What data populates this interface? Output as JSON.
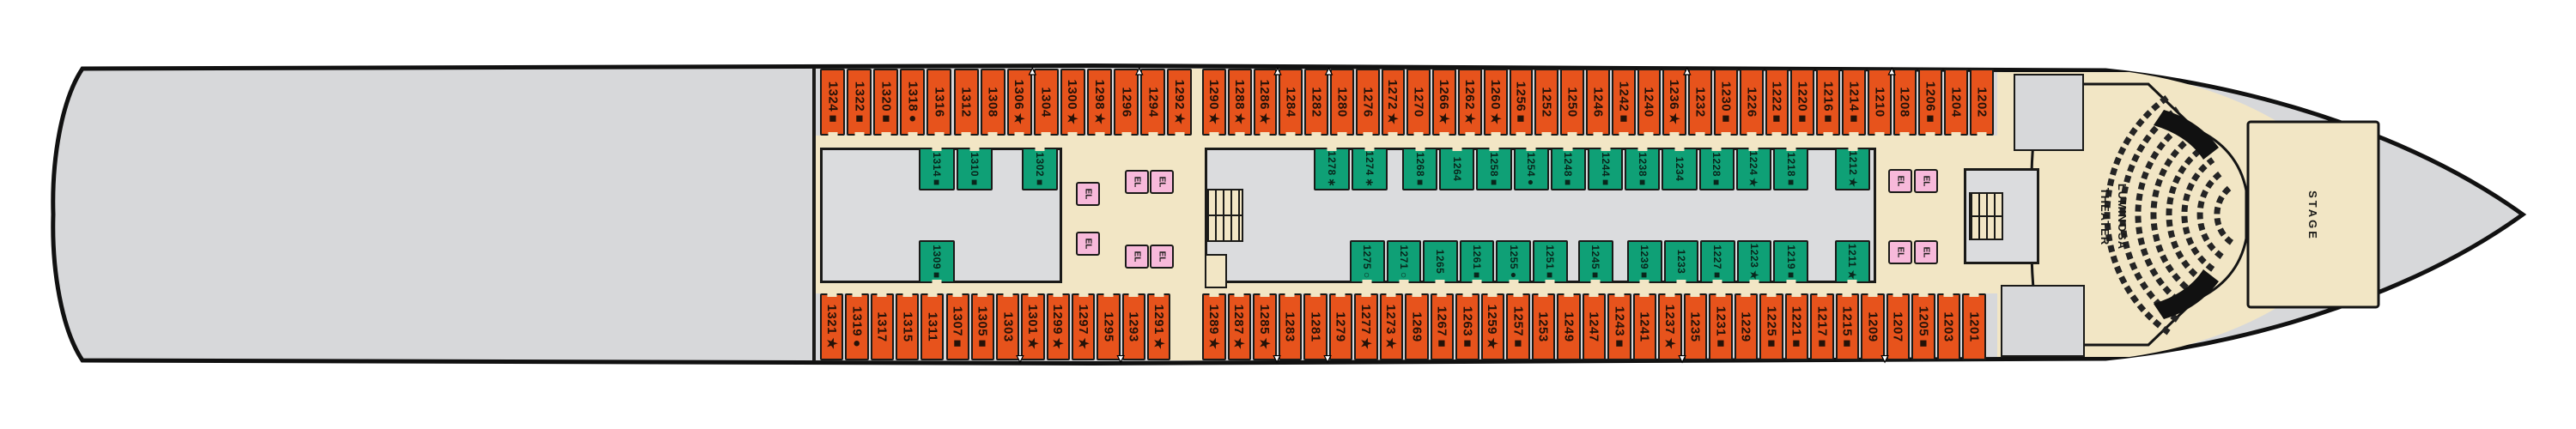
{
  "labels": {
    "elevator": "EL",
    "theater_line1": "LUMINOSA",
    "theater_line2": "THEATER",
    "stage": "STAGE"
  },
  "colors": {
    "cabin_orange": "#E7531C",
    "cabin_green": "#0FA076",
    "elevator_pink": "#F7B9DA",
    "corridor_tan": "#F2E6C5",
    "deck_gray": "#D7D8DA",
    "outline_black": "#1a1a18"
  },
  "rows": {
    "top_outer": [
      {
        "n": "1324",
        "s": "■"
      },
      {
        "n": "1322",
        "s": "■"
      },
      {
        "n": "1320",
        "s": "■"
      },
      {
        "n": "1318",
        "s": "●"
      },
      {
        "n": "1316"
      },
      {
        "n": "1312"
      },
      {
        "n": "1308"
      },
      {
        "n": "1306",
        "s": "★",
        "t": 1
      },
      {
        "n": "1304"
      },
      {
        "n": "1300",
        "s": "★"
      },
      {
        "n": "1298",
        "s": "★"
      },
      {
        "n": "1296",
        "t": 1
      },
      {
        "n": "1294"
      },
      {
        "n": "1292",
        "s": "★"
      },
      {
        "n": "1290",
        "s": "★"
      },
      {
        "n": "1288",
        "s": "★"
      },
      {
        "n": "1286",
        "s": "★",
        "t": 1
      },
      {
        "n": "1284"
      },
      {
        "n": "1282",
        "t": 1
      },
      {
        "n": "1280"
      },
      {
        "n": "1276"
      },
      {
        "n": "1272",
        "s": "★"
      },
      {
        "n": "1270"
      },
      {
        "n": "1266",
        "s": "★"
      },
      {
        "n": "1262",
        "s": "★"
      },
      {
        "n": "1260",
        "s": "★"
      },
      {
        "n": "1256",
        "s": "■"
      },
      {
        "n": "1252"
      },
      {
        "n": "1250"
      },
      {
        "n": "1246"
      },
      {
        "n": "1242",
        "s": "■"
      },
      {
        "n": "1240"
      },
      {
        "n": "1236",
        "s": "★",
        "t": 1
      },
      {
        "n": "1232"
      },
      {
        "n": "1230",
        "s": "■"
      },
      {
        "n": "1226"
      },
      {
        "n": "1222",
        "s": "■"
      },
      {
        "n": "1220",
        "s": "■"
      },
      {
        "n": "1216",
        "s": "■"
      },
      {
        "n": "1214",
        "s": "■"
      },
      {
        "n": "1210",
        "t": 1
      },
      {
        "n": "1208"
      },
      {
        "n": "1206",
        "s": "■"
      },
      {
        "n": "1204"
      },
      {
        "n": "1202"
      }
    ],
    "top_inner_aft": [
      {
        "n": "1314",
        "s": "■"
      },
      {
        "n": "1310",
        "s": "■"
      },
      {
        "n": "1302",
        "s": "■"
      }
    ],
    "top_inner": [
      {
        "n": "1278",
        "s": "∗"
      },
      {
        "n": "1274",
        "s": "∗"
      },
      {
        "n": "1268",
        "s": "■"
      },
      {
        "n": "1264"
      },
      {
        "n": "1258",
        "s": "■"
      },
      {
        "n": "1254",
        "s": "●"
      },
      {
        "n": "1248",
        "s": "■"
      },
      {
        "n": "1244",
        "s": "■"
      },
      {
        "n": "1238",
        "s": "■"
      },
      {
        "n": "1234"
      },
      {
        "n": "1228",
        "s": "■"
      },
      {
        "n": "1224",
        "s": "★"
      },
      {
        "n": "1218",
        "s": "■"
      },
      {
        "n": "1212",
        "s": "★"
      }
    ],
    "bottom_inner_aft": [
      {
        "n": "1309",
        "s": "■"
      }
    ],
    "bottom_inner": [
      {
        "n": "1275",
        "s": "○"
      },
      {
        "n": "1271",
        "s": "○"
      },
      {
        "n": "1265"
      },
      {
        "n": "1261",
        "s": "■"
      },
      {
        "n": "1255",
        "s": "●"
      },
      {
        "n": "1251",
        "s": "■"
      },
      {
        "n": "1245",
        "s": "■"
      },
      {
        "n": "1239",
        "s": "■"
      },
      {
        "n": "1233"
      },
      {
        "n": "1227",
        "s": "■"
      },
      {
        "n": "1223",
        "s": "★"
      },
      {
        "n": "1219",
        "s": "■"
      },
      {
        "n": "1211",
        "s": "★"
      }
    ],
    "bottom_outer": [
      {
        "n": "1321",
        "s": "★"
      },
      {
        "n": "1319",
        "s": "●"
      },
      {
        "n": "1317"
      },
      {
        "n": "1315"
      },
      {
        "n": "1311"
      },
      {
        "n": "1307",
        "s": "■"
      },
      {
        "n": "1305",
        "s": "■"
      },
      {
        "n": "1303",
        "t": 1
      },
      {
        "n": "1301",
        "s": "★"
      },
      {
        "n": "1299",
        "s": "★"
      },
      {
        "n": "1297",
        "s": "★"
      },
      {
        "n": "1295",
        "t": 1
      },
      {
        "n": "1293"
      },
      {
        "n": "1291",
        "s": "★"
      },
      {
        "n": "1289",
        "s": "★"
      },
      {
        "n": "1287",
        "s": "★"
      },
      {
        "n": "1285",
        "s": "★",
        "t": 1
      },
      {
        "n": "1283"
      },
      {
        "n": "1281",
        "t": 1
      },
      {
        "n": "1279"
      },
      {
        "n": "1277",
        "s": "★"
      },
      {
        "n": "1273",
        "s": "★"
      },
      {
        "n": "1269"
      },
      {
        "n": "1267",
        "s": "■"
      },
      {
        "n": "1263",
        "s": "■"
      },
      {
        "n": "1259",
        "s": "★"
      },
      {
        "n": "1257",
        "s": "■"
      },
      {
        "n": "1253"
      },
      {
        "n": "1249"
      },
      {
        "n": "1247"
      },
      {
        "n": "1243",
        "s": "■"
      },
      {
        "n": "1241"
      },
      {
        "n": "1237",
        "s": "★",
        "t": 1
      },
      {
        "n": "1235"
      },
      {
        "n": "1231",
        "s": "■"
      },
      {
        "n": "1229"
      },
      {
        "n": "1225",
        "s": "■"
      },
      {
        "n": "1221",
        "s": "■"
      },
      {
        "n": "1217",
        "s": "■"
      },
      {
        "n": "1215",
        "s": "■"
      },
      {
        "n": "1209",
        "t": 1
      },
      {
        "n": "1207"
      },
      {
        "n": "1205",
        "s": "■"
      },
      {
        "n": "1203"
      },
      {
        "n": "1201"
      }
    ]
  }
}
